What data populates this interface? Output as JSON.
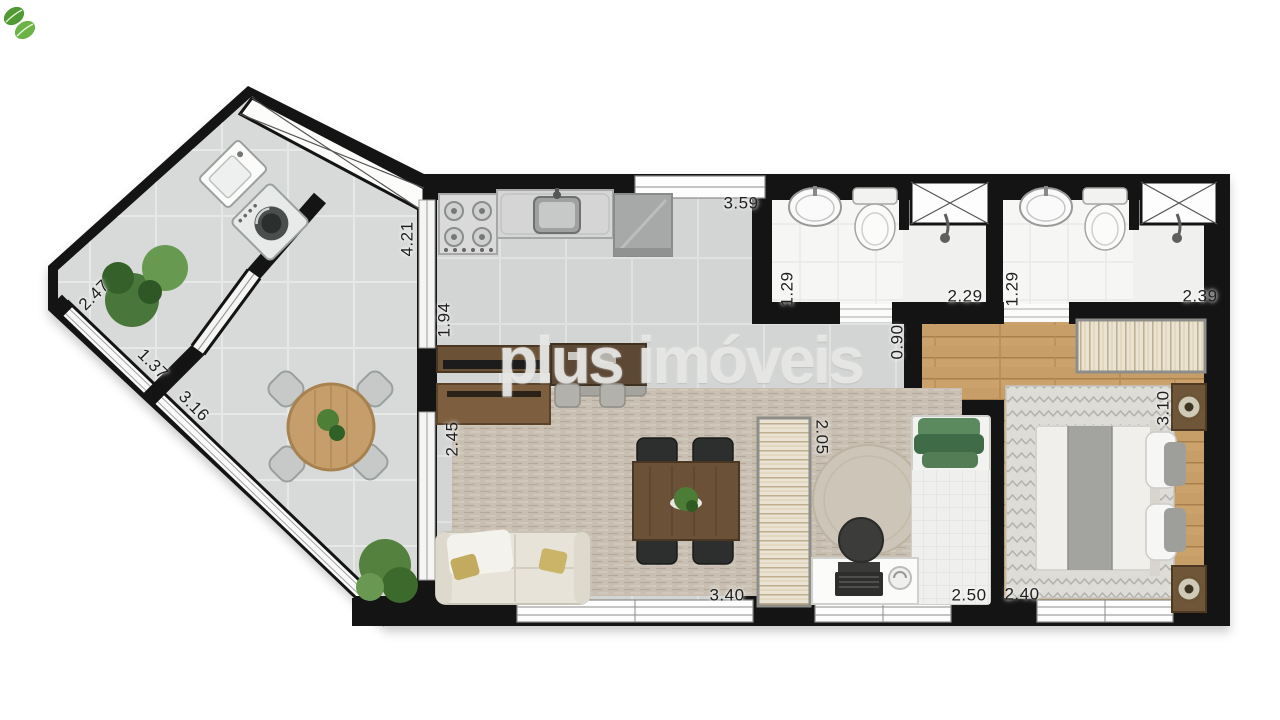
{
  "watermark": {
    "text": "plus imóveis"
  },
  "dimensions": {
    "service_wall": "2.47",
    "terrace_rail_a": "1.37",
    "terrace_rail_b": "3.16",
    "kitchen_left": "4.21",
    "terrace_door": "1.94",
    "kitchen_width": "3.59",
    "bath1_depth": "1.29",
    "bath1_width": "2.29",
    "bath2_depth": "1.29",
    "bath2_width": "2.39",
    "hall_width": "0.90",
    "living_left": "2.45",
    "bedroom2_depth": "2.05",
    "bedroom1_depth": "3.10",
    "living_width": "3.40",
    "bedroom2_width": "2.50",
    "bedroom1_width": "2.40"
  },
  "colors": {
    "wall": "#141414",
    "terrace_floor": "#d8dad9",
    "interior_floor": "#d3d5d4",
    "wood_floor": "#c79e67",
    "bath_floor": "#f6f6f5",
    "carpet": "#c8bfb2",
    "accent_green": "#4c7c36",
    "watermark_gray": "#eaeae7"
  }
}
